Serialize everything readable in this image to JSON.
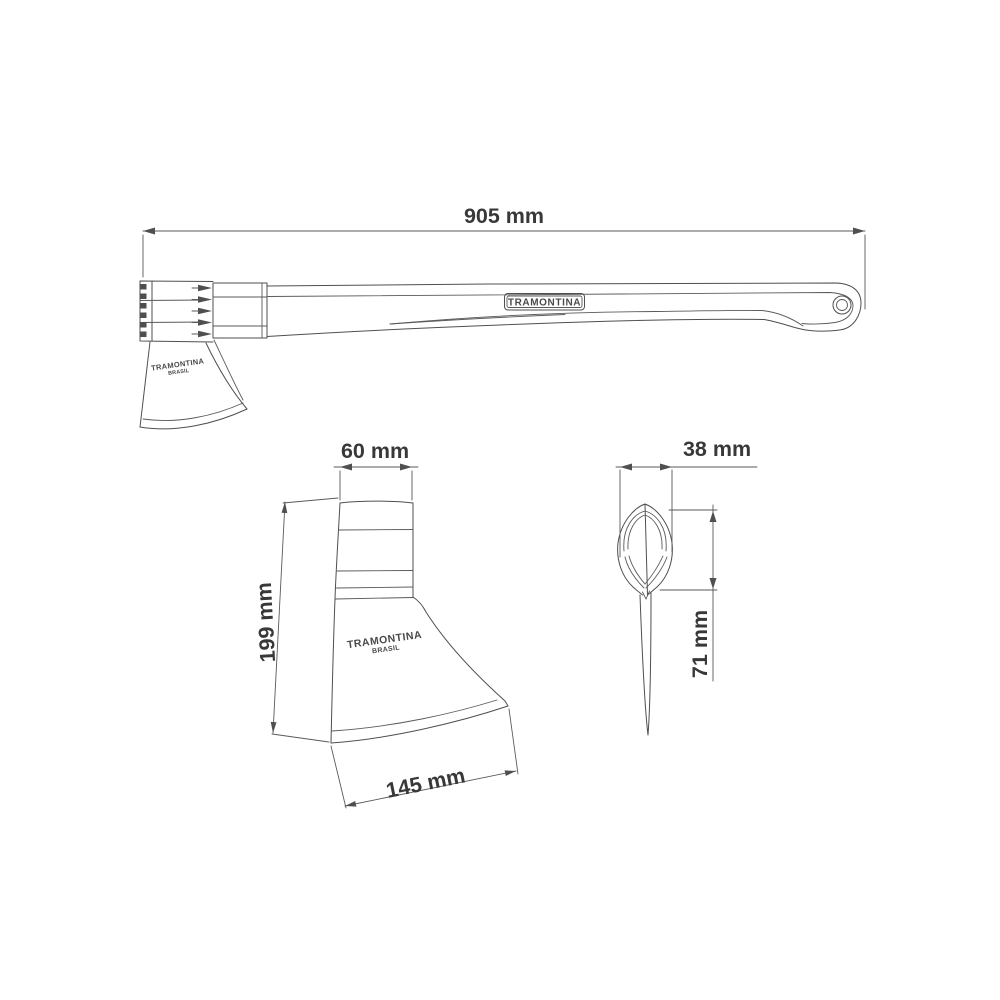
{
  "drawing": {
    "background": "#ffffff",
    "line_color": "#4f4f4f",
    "text_color": "#383838",
    "dims": {
      "overall_length": "905 mm",
      "head_top_width": "60 mm",
      "head_height": "199 mm",
      "blade_edge_width": "145 mm",
      "eye_width": "38 mm",
      "eye_depth": "71 mm"
    },
    "branding": {
      "handle_plate": "TRAMONTINA",
      "stamp_line1": "TRAMONTINA",
      "stamp_line2": "BRASIL"
    }
  }
}
